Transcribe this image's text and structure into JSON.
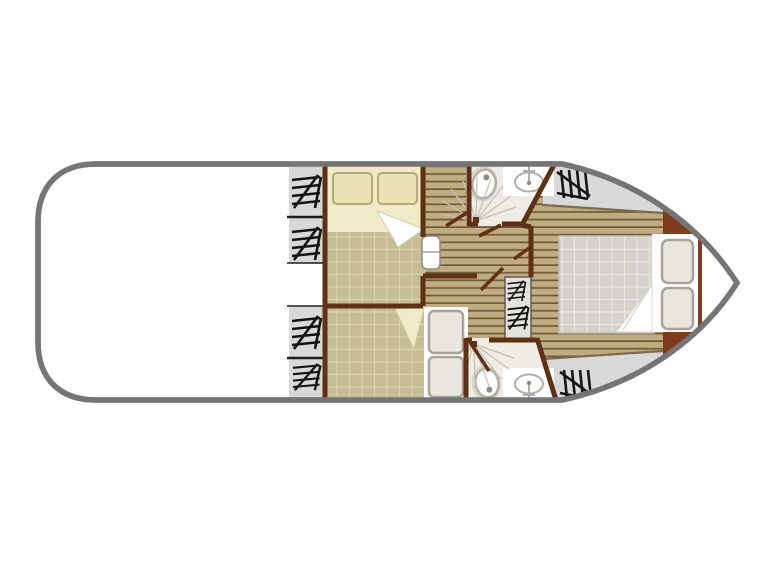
{
  "scene": {
    "type": "boat-floor-plan",
    "canvas": {
      "width": 768,
      "height": 576
    }
  },
  "rooms": [
    "aft-deck",
    "port-side-stairs",
    "forward-cabin-double-bed",
    "lower-cabin-twin-bed",
    "corridor",
    "bathroom-top",
    "bathroom-bottom",
    "central-stairs",
    "bow-bedroom",
    "bow-deck"
  ],
  "icons": {
    "stairs": "stairs-hatch-icon",
    "toilet": "toilet-icon",
    "sink": "sink-icon",
    "shower": "shower-spray-icon",
    "door": "door-swing-icon",
    "bed": "bed-icon",
    "pillow": "pillow-icon"
  },
  "colors": {
    "background": "#ffffff",
    "hull_fill": "#ffffff",
    "hull_outline": "#757575",
    "deck_gray": "#d9d9d9",
    "panel_gray": "#d8d8d8",
    "panel_divider": "#1c1c1c",
    "hatch_black": "#141414",
    "wall": "#5e3014",
    "headboard": "#7e3c1d",
    "boundary": "#7d6950",
    "plank_light": "#c0ac80",
    "plank_dark": "#6f5939",
    "carpet": "#c7bd94",
    "carpet_grid": "#d9d2ae",
    "bed_cream": "#f1eac6",
    "pillow_cream": "#eae2b5",
    "pillow_cream_stroke": "#b5aa7c",
    "sheet_white": "#ffffff",
    "fold_line": "#d5cbae",
    "mattress": "#d6d2cb",
    "mattress_grid": "#e9e7e2",
    "mattress_edge": "#c2beb7",
    "pillow_gray": "#e9e6df",
    "pillow_gray_stroke": "#a7a399",
    "bathroom_floor": "#efece4",
    "counter": "#ffffff",
    "fixture_stroke": "#b2afa6",
    "fixture_light": "#d6d3cc",
    "fixture_dot": "#8f8c83",
    "spray": "#c6c2b7",
    "stairs_strip": "#e4e2dc",
    "strip_outline": "#454545",
    "door_white": "#ffffff",
    "door_stroke": "#8f8b81"
  }
}
